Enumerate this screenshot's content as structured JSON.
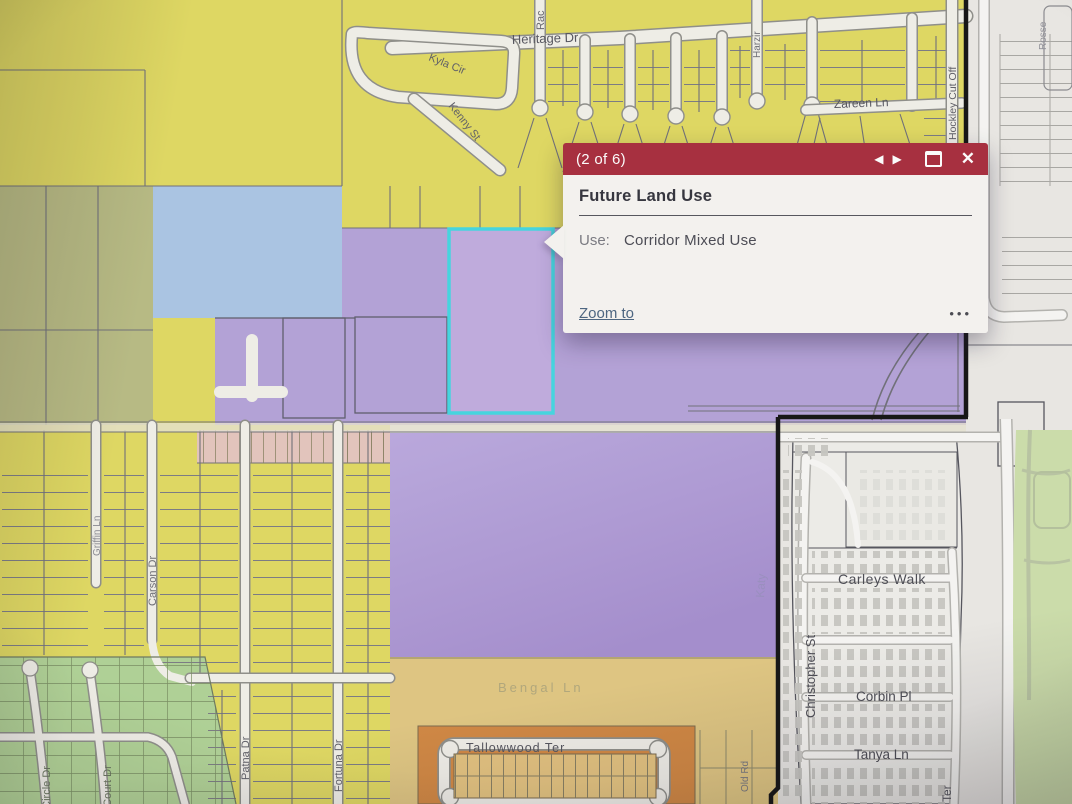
{
  "popup": {
    "pagination": "(2 of 6)",
    "title": "Future Land Use",
    "field_label": "Use:",
    "field_value": "Corridor Mixed Use",
    "zoom_to_label": "Zoom to",
    "prev_icon": "◀",
    "next_icon": "▶",
    "close_icon": "✕",
    "ellipsis_icon": "•••",
    "header_color": "#b12b3d"
  },
  "map": {
    "selected_parcel_outline": "#3ad9e4",
    "labels": {
      "heritage": "Heritage Dr",
      "rac": "Rac",
      "kyla": "Kyla Cir",
      "kenny": "Kenny St",
      "harzir": "Harzir",
      "zareen": "Zareen Ln",
      "hockley": "Hockley Cut Off",
      "rosse": "Rosse",
      "griffin": "Griffin Ln",
      "carson": "Carson Dr",
      "patna": "Patna Dr",
      "fortuna": "Fortuna Dr",
      "circle": "e Circle Dr",
      "court": "e Court Dr",
      "bengal": "Bengal Ln",
      "tallowwood": "Tallowwood Ter",
      "katy": "Katy",
      "old_rd": "Old Rd",
      "carleys": "Carleys Walk",
      "christopher": "Christopher St",
      "corbin": "Corbin Pl",
      "tanya": "Tanya Ln",
      "ter": "Ter"
    },
    "palette": {
      "residential_yellow": "#e2da58",
      "olive_green": "#b9bc80",
      "light_blue": "#a9c6e8",
      "purple_mixed_use": "#b29bdb",
      "salmon": "#e7c6bd",
      "green_residential": "#afd492",
      "tan": "#e3c77c",
      "orange": "#d8873c",
      "basemap_gray": "#ebe9e5",
      "park_green": "#ccdfa8",
      "boundary_black": "#141414"
    }
  }
}
